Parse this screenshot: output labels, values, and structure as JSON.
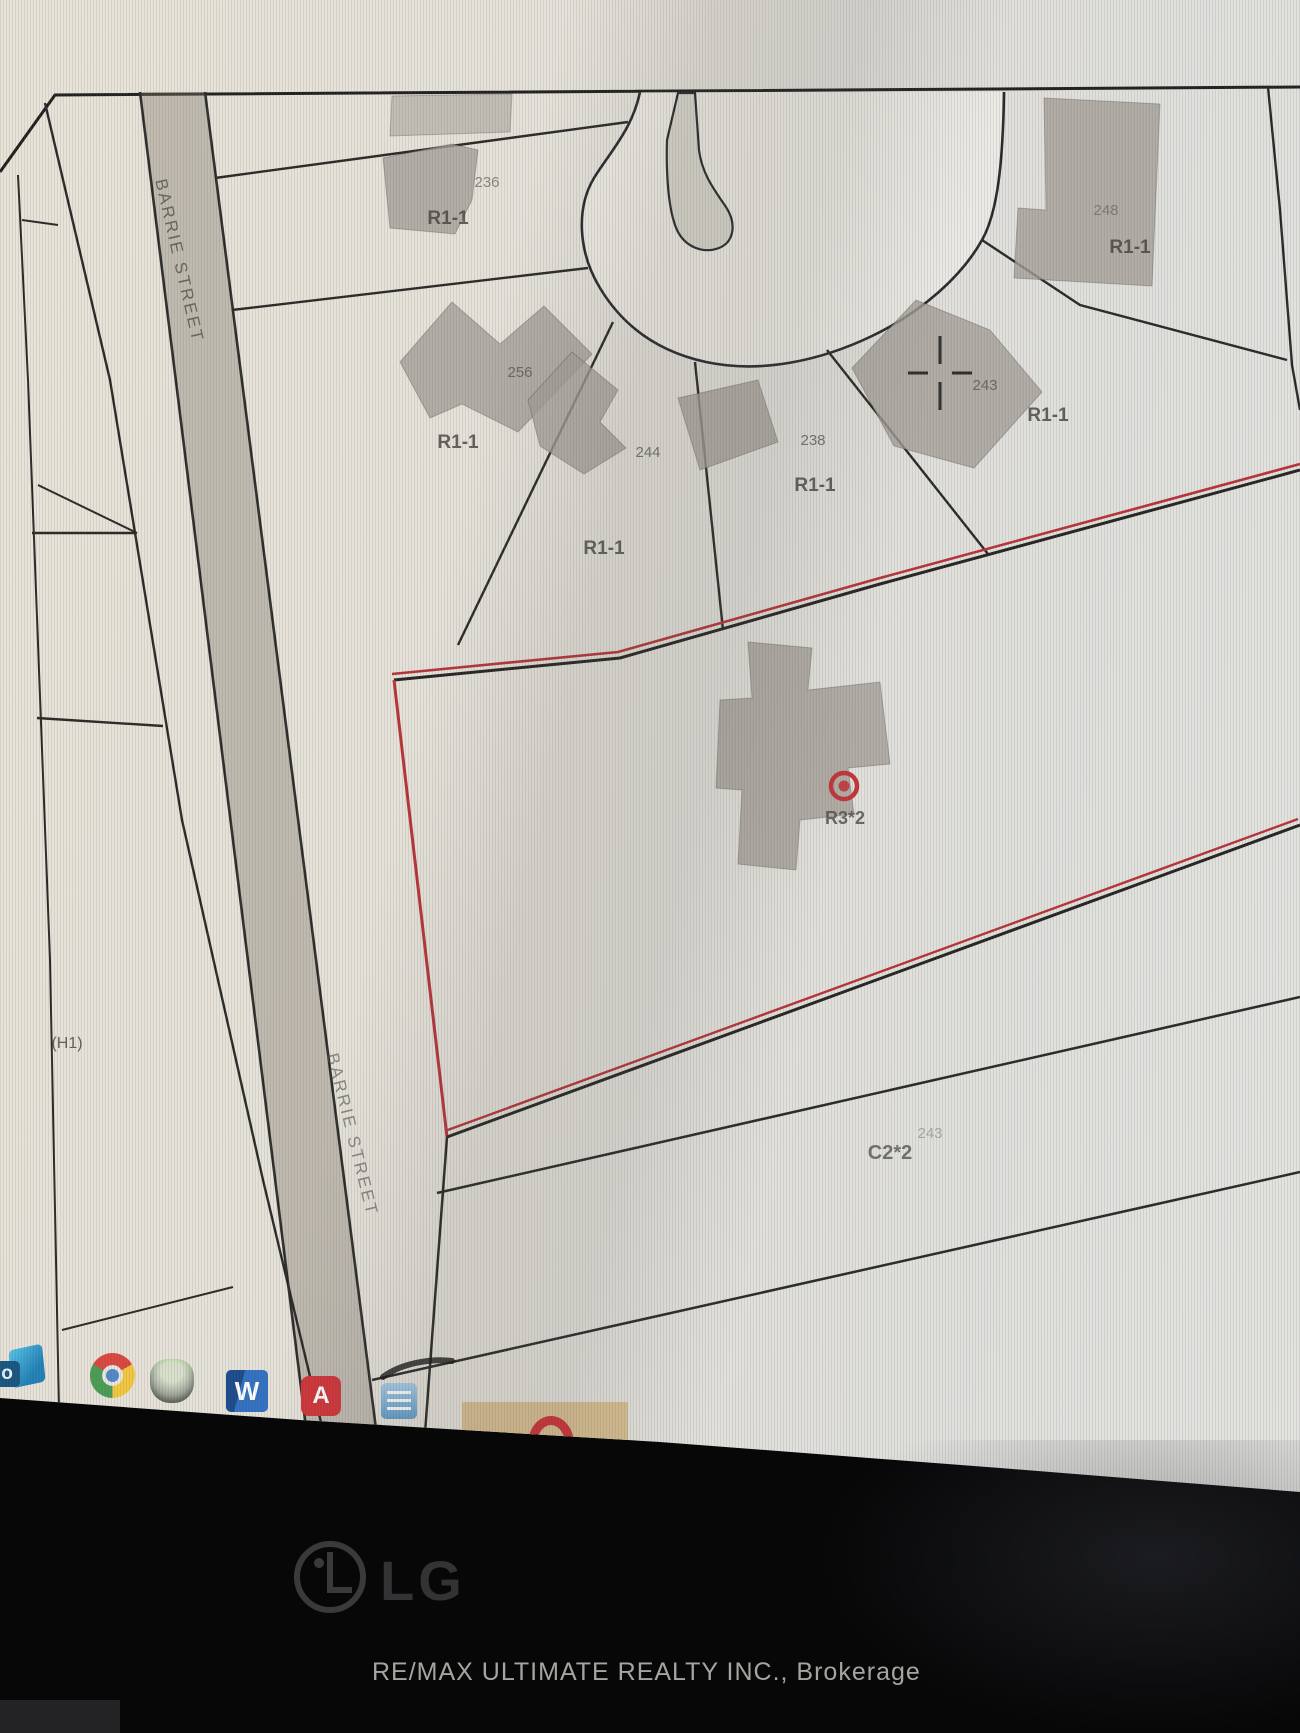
{
  "screen": {
    "map": {
      "street_name_labels": [
        {
          "text": "BARRIE STREET"
        },
        {
          "text": "BARRIE STREET"
        }
      ],
      "zoning_labels": [
        {
          "text": "R1-1"
        },
        {
          "text": "R1-1"
        },
        {
          "text": "R1-1"
        },
        {
          "text": "R1-1"
        },
        {
          "text": "R1-1"
        },
        {
          "text": "R1-1"
        },
        {
          "text": "R3*2"
        },
        {
          "text": "C2*2"
        },
        {
          "text": "(H1)"
        }
      ],
      "lot_numbers": [
        {
          "text": "236"
        },
        {
          "text": "256"
        },
        {
          "text": "244"
        },
        {
          "text": "238"
        },
        {
          "text": "243"
        },
        {
          "text": "248"
        },
        {
          "text": "243"
        }
      ],
      "marker": {
        "type": "red-circle-subject-property"
      }
    },
    "taskbar": {
      "icons": [
        {
          "name": "outlook",
          "label": "o"
        },
        {
          "name": "chrome",
          "label": ""
        },
        {
          "name": "antivirus-app",
          "label": ""
        },
        {
          "name": "word",
          "label": "W"
        },
        {
          "name": "acrobat",
          "label": "A"
        },
        {
          "name": "mail-app",
          "label": ""
        },
        {
          "name": "opera",
          "label": ""
        }
      ]
    }
  },
  "monitor": {
    "brand": "LG"
  },
  "caption": {
    "text": "RE/MAX ULTIMATE REALTY INC., Brokerage"
  },
  "colors": {
    "parcel_red": "#b63036",
    "marker_red": "#c03238",
    "map_line": "#22221f",
    "building_gray": "#a29e96",
    "street_band": "#8d867a",
    "opera_red": "#cb2f36",
    "highlight_tile": "#d6ba8a"
  }
}
